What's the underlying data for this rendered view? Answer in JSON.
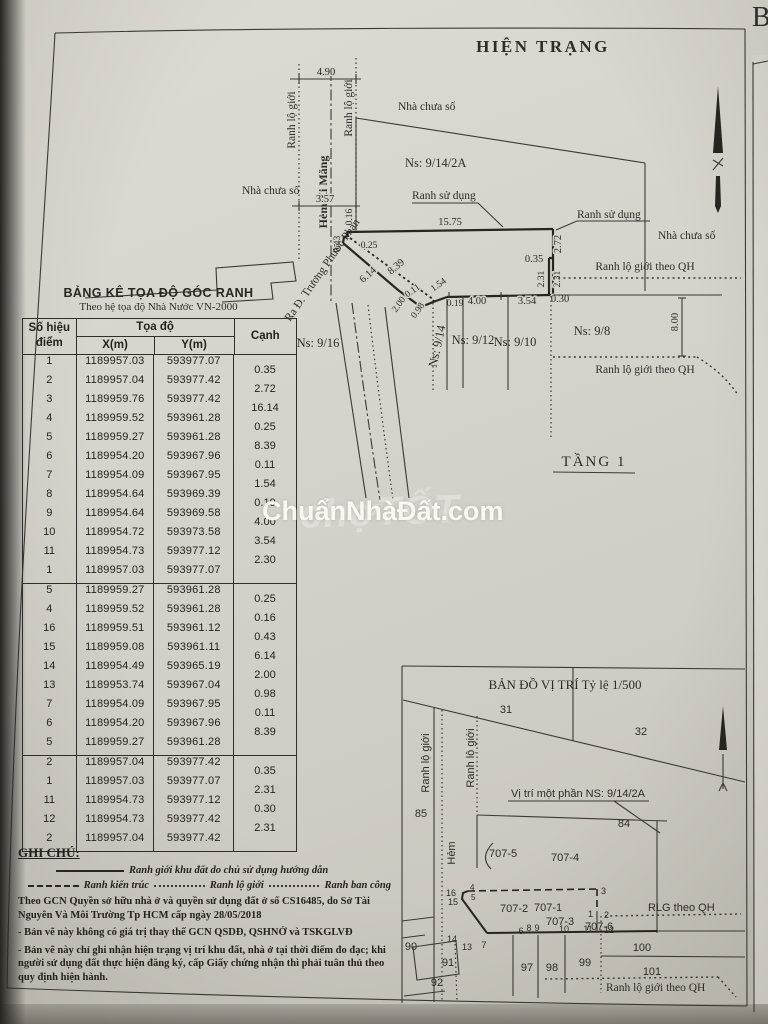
{
  "page": {
    "title": "HIỆN TRẠNG",
    "floor_label": "TẦNG 1",
    "corner_letter": "B",
    "ink_color": "#26251f",
    "paper_color": "#d5d2cb"
  },
  "watermark": {
    "main": "ChuẩnNhàĐất.com",
    "ghost": "chợTỐT"
  },
  "shared": {
    "ranh_lo_gioi": "Ranh lộ giới",
    "nha_chua_so": "Nhà chưa số",
    "ranh_su_dung": "Ranh sử dụng",
    "ranh_lo_gioi_qh": "Ranh lộ giới theo QH",
    "hem_xi_mang": "Hẻm Xi Măng",
    "road_out": "Ra Đ. Trương Phước Phan",
    "hem": "Hẻm"
  },
  "site_plan": {
    "ns": {
      "n9_14_2a": "Ns: 9/14/2A",
      "n9_16": "Ns: 9/16",
      "n9_14": "Ns: 9/14",
      "n9_12": "Ns: 9/12",
      "n9_10": "Ns: 9/10",
      "n9_8": "Ns: 9/8"
    },
    "dims": {
      "d490": "4.90",
      "d357": "3.57",
      "d1575": "15.75",
      "d016": "0.16",
      "d043": "0.43",
      "d025": "0.25",
      "d614": "6.14",
      "d839": "8.39",
      "d200": "2.00",
      "d098": "0.98",
      "d011": "0.11",
      "d154": "1.54",
      "d019": "0.19",
      "d400": "4.00",
      "d354": "3.54",
      "d030": "0.30",
      "d035": "0.35",
      "d272": "2.72",
      "d231": "2.31",
      "d800": "8.00"
    }
  },
  "coordinate_table": {
    "title": "BẢNG KÊ TỌA ĐỘ GÓC RANH",
    "subtitle": "Theo hệ tọa độ Nhà Nước VN-2000",
    "headers": {
      "point": "Số hiệu điểm",
      "coords": "Tọa độ",
      "x": "X(m)",
      "y": "Y(m)",
      "edge": "Cạnh"
    },
    "blocks": [
      {
        "rows": [
          {
            "p": "1",
            "x": "1189957.03",
            "y": "593977.07"
          },
          {
            "p": "2",
            "x": "1189957.04",
            "y": "593977.42"
          },
          {
            "p": "3",
            "x": "1189959.76",
            "y": "593977.42"
          },
          {
            "p": "4",
            "x": "1189959.52",
            "y": "593961.28"
          },
          {
            "p": "5",
            "x": "1189959.27",
            "y": "593961.28"
          },
          {
            "p": "6",
            "x": "1189954.20",
            "y": "593967.96"
          },
          {
            "p": "7",
            "x": "1189954.09",
            "y": "593967.95"
          },
          {
            "p": "8",
            "x": "1189954.64",
            "y": "593969.39"
          },
          {
            "p": "9",
            "x": "1189954.64",
            "y": "593969.58"
          },
          {
            "p": "10",
            "x": "1189954.72",
            "y": "593973.58"
          },
          {
            "p": "11",
            "x": "1189954.73",
            "y": "593977.12"
          },
          {
            "p": "1",
            "x": "1189957.03",
            "y": "593977.07"
          }
        ],
        "edges": [
          "0.35",
          "2.72",
          "16.14",
          "0.25",
          "8.39",
          "0.11",
          "1.54",
          "0.19",
          "4.00",
          "3.54",
          "2.30"
        ]
      },
      {
        "rows": [
          {
            "p": "5",
            "x": "1189959.27",
            "y": "593961.28"
          },
          {
            "p": "4",
            "x": "1189959.52",
            "y": "593961.28"
          },
          {
            "p": "16",
            "x": "1189959.51",
            "y": "593961.12"
          },
          {
            "p": "15",
            "x": "1189959.08",
            "y": "593961.11"
          },
          {
            "p": "14",
            "x": "1189954.49",
            "y": "593965.19"
          },
          {
            "p": "13",
            "x": "1189953.74",
            "y": "593967.04"
          },
          {
            "p": "7",
            "x": "1189954.09",
            "y": "593967.95"
          },
          {
            "p": "6",
            "x": "1189954.20",
            "y": "593967.96"
          },
          {
            "p": "5",
            "x": "1189959.27",
            "y": "593961.28"
          }
        ],
        "edges": [
          "0.25",
          "0.16",
          "0.43",
          "6.14",
          "2.00",
          "0.98",
          "0.11",
          "8.39"
        ]
      },
      {
        "rows": [
          {
            "p": "2",
            "x": "1189957.04",
            "y": "593977.42"
          },
          {
            "p": "1",
            "x": "1189957.03",
            "y": "593977.07"
          },
          {
            "p": "11",
            "x": "1189954.73",
            "y": "593977.12"
          },
          {
            "p": "12",
            "x": "1189954.73",
            "y": "593977.42"
          },
          {
            "p": "2",
            "x": "1189957.04",
            "y": "593977.42"
          }
        ],
        "edges": [
          "0.35",
          "2.31",
          "0.30",
          "2.31"
        ]
      }
    ]
  },
  "notes": {
    "title": "GHI CHÚ:",
    "legend_boundary": "Ranh giới khu đất do chủ sử dụng hướng dẫn",
    "legend_arch": "Ranh kiến trúc",
    "legend_row": "Ranh lộ giới",
    "legend_balcony": "Ranh ban công",
    "note1": "Theo GCN Quyền sở hữu nhà ở và quyền sử dụng đất ở số  CS16485, do Sở Tài Nguyên Và Môi Trường Tp HCM cấp ngày 28/05/2018",
    "note2": "- Bản vẽ này không có giá trị thay thế GCN QSDĐ,  QSHNỞ và TSKGLVĐ",
    "note3": "- Bản vẽ này chỉ ghi nhận hiện trạng vị trí khu đất, nhà ở tại thời điểm đo đạc; khi người sử dụng đất thực hiện đăng ký, cấp Giấy chứng nhận thì phải tuân thủ theo quy định hiện hành."
  },
  "location_map": {
    "title": "BẢN ĐỒ VỊ TRÍ Tỷ lệ 1/500",
    "vi_tri": "Vị trí một phần NS: 9/14/2A",
    "rlg": "RLG theo QH",
    "parcels": {
      "p31": "31",
      "p32": "32",
      "p84": "84",
      "p85": "85",
      "p90": "90",
      "p91": "91",
      "p92": "92",
      "p97": "97",
      "p98": "98",
      "p99": "99",
      "p100": "100",
      "p101": "101",
      "p707_1": "707-1",
      "p707_2": "707-2",
      "p707_3": "707-3",
      "p707_4": "707-4",
      "p707_5": "707-5",
      "p707_6": "707-6"
    },
    "points": {
      "n1": "1",
      "n2": "2",
      "n3": "3",
      "n4": "4",
      "n5": "5",
      "n6": "6",
      "n7": "7",
      "n8": "8",
      "n9": "9",
      "n10": "10",
      "n11": "11",
      "n12": "12",
      "n13": "13",
      "n14": "14",
      "n15": "15",
      "n16": "16"
    }
  }
}
